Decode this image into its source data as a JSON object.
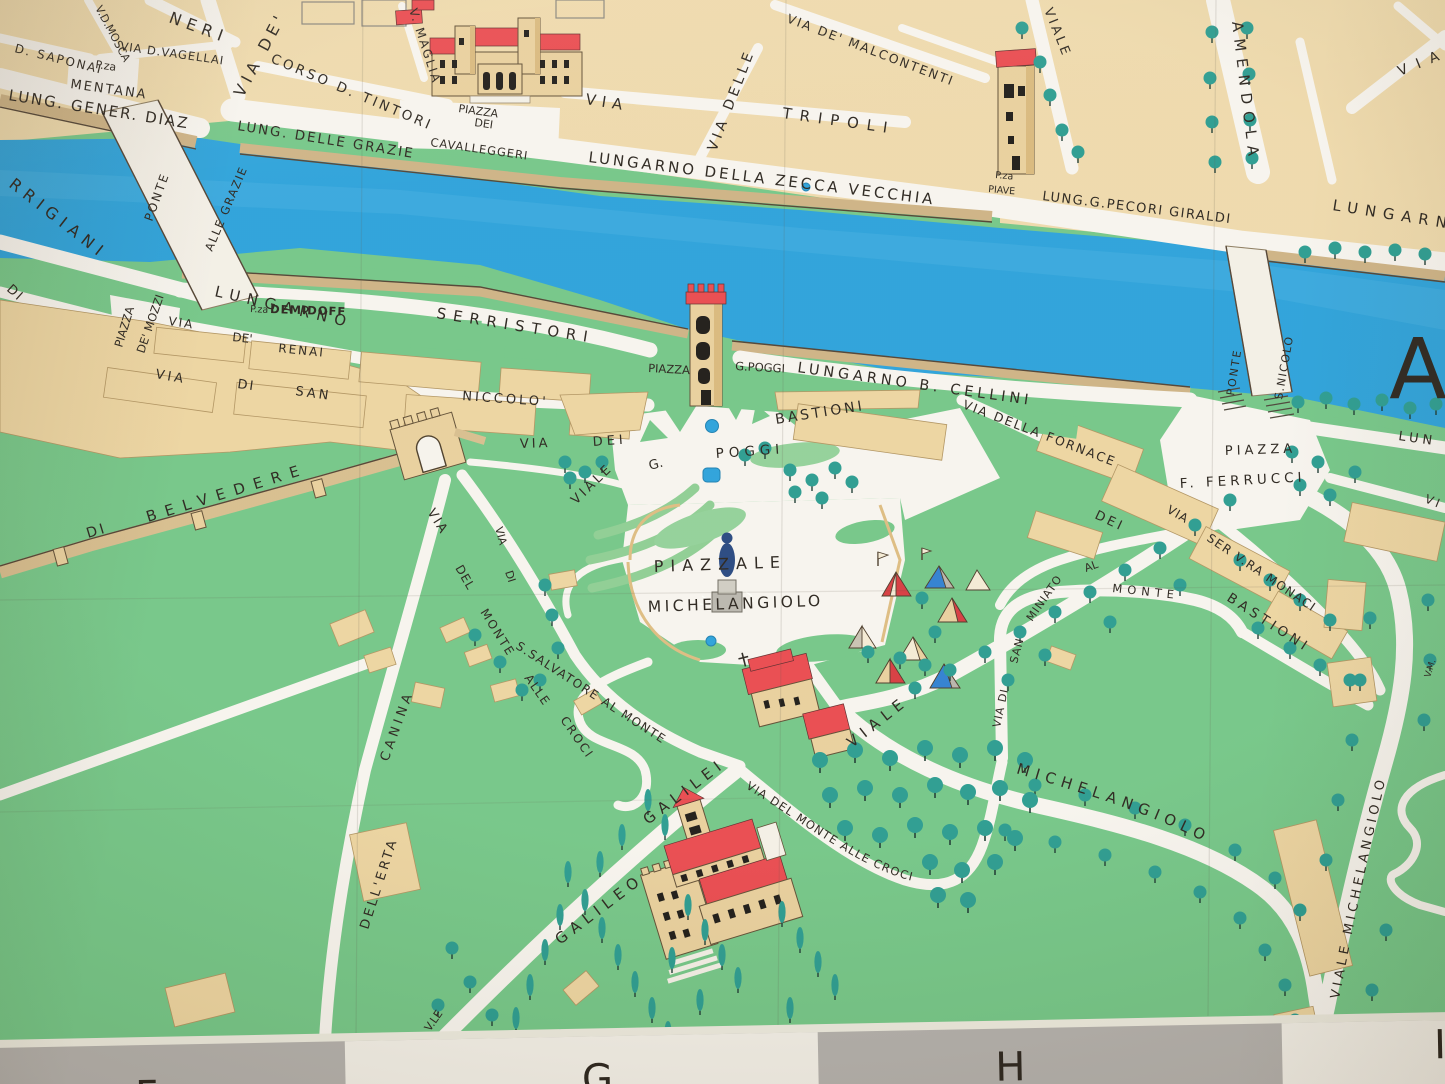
{
  "map_type": "pictorial-street-map-photo",
  "colors": {
    "street_white": "#f7f4ee",
    "block_tan": "#eed9ab",
    "grass_green": "#74c687",
    "park_pale_green": "#92d098",
    "tree_teal": "#2a9b8f",
    "river_blue": "#2ba1da",
    "roof_red": "#e9494e",
    "embankment_tan": "#cdb284",
    "wall_tan": "#d7bd8d",
    "label_ink": "#2a241d",
    "statue_navy": "#27477f",
    "band_gray": "#b3b0ac",
    "band_cream": "#f2efe7"
  },
  "labels": {
    "n_saponai": "D. SAPONAI",
    "n_mosca": "V.D.MOSCA",
    "n_neri": "NERI",
    "n_vagellai": "VIA D.VAGELLAI",
    "n_pza_mentana1": "P.za",
    "n_pza_mentana2": "MENTANA",
    "n_diaz": "LUNG. GENER. DIAZ",
    "n_via_de_benci": "VIA DE'",
    "n_corso_tintori": "CORSO D. TINTORI",
    "n_magliabechi": "V. MAGLIA",
    "n_lung_delle_grazie": "LUNG. DELLE GRAZIE",
    "n_cavalleggeri1": "PIAZZA",
    "n_cavalleggeri2": "DEI",
    "n_cavalleggeri3": "CAVALLEGGERI",
    "n_via_tripoli1": "VIA",
    "n_via_tripoli2": "TRIPOLI",
    "n_via_delle": "VIA DELLE",
    "n_malcontenti": "VIA DE' MALCONTENTI",
    "n_zecca_vecchia": "LUNGARNO DELLA ZECCA VECCHIA",
    "n_pza_piave1": "P.za",
    "n_pza_piave2": "PIAVE",
    "n_pecori_giraldi": "LUNG.G.PECORI GIRALDI",
    "n_lungarno_right": "LUNGARN",
    "n_viale_giovine": "VIALE",
    "n_amendola": "AMENDOLA",
    "n_via_corner": "VIA",
    "ponte_grazie1": "PONTE",
    "ponte_grazie2": "ALLE GRAZIE",
    "torrigiani": "RRIGIANI",
    "bardi_di": "DI",
    "mozzi1": "PIAZZA",
    "mozzi2": "DE' MOZZI",
    "serristori1": "LUNGARNO",
    "serristori2": "SERRISTORI",
    "demidoff1": "P.za",
    "demidoff2": "DEMIDOFF",
    "renai1": "VIA",
    "renai2": "DE'",
    "renai3": "RENAI",
    "niccolo1": "VIA",
    "niccolo2": "DI",
    "niccolo3": "SAN",
    "niccolo4": "NICCOLO'",
    "piazza_poggi1": "PIAZZA",
    "piazza_poggi2": "G.POGGI",
    "cellini": "LUNGARNO B. CELLINI",
    "ponte_nicolo1": "PONTE",
    "ponte_nicolo2": "S.NICOLO",
    "arno_a": "A",
    "fornace": "VIA DELLA FORNACE",
    "ferrucci1": "PIAZZA",
    "ferrucci2": "F. FERRUCCI",
    "lun_right": "LUN",
    "vi_right": "VI",
    "vm_right": "V.M.",
    "via_dei_w1": "VIA",
    "via_dei_w2": "DEI",
    "bastioni_w": "BASTIONI",
    "dei_e": "DEI",
    "bastioni_e": "BASTIONI",
    "monaci1": "VIA",
    "monaci2": "SER V.RA MONACI",
    "belvedere1": "DI",
    "belvedere2": "BELVEDERE",
    "vialepoggi1": "VIALE",
    "vialepoggi2": "G.",
    "vialepoggi3": "POGGI",
    "piazzale1": "PIAZZALE",
    "piazzale2": "MICHELANGIOLO",
    "erta1": "VIA",
    "erta2": "DELL'ERTA",
    "erta3": "CANINA",
    "croci_w_via": "VIA",
    "croci_w_di": "DI",
    "croci_w_del": "DEL",
    "croci_w_monte": "MONTE",
    "croci_w_alle": "ALLE",
    "croci_w_croci": "CROCI",
    "salvatore": "S.SALVATORE AL MONTE",
    "sm_road1": "VIA DI",
    "sm_road2": "SAN",
    "sm_road3": "MINIATO",
    "sm_road4": "AL",
    "sm_road5": "MONTE",
    "vmich_c1": "VIALE",
    "vmich_c2": "MICHELANGIOLO",
    "vmich_r": "VIALE MICHELANGIOLO",
    "croci_e": "VIA DEL MONTE ALLE CROCI",
    "galileo1": "V.LE",
    "galileo2": "GALILEO",
    "galileo3": "GALILEI"
  },
  "grid_letters": {
    "f": "F",
    "g": "G",
    "h": "H",
    "i_partial": "I"
  }
}
